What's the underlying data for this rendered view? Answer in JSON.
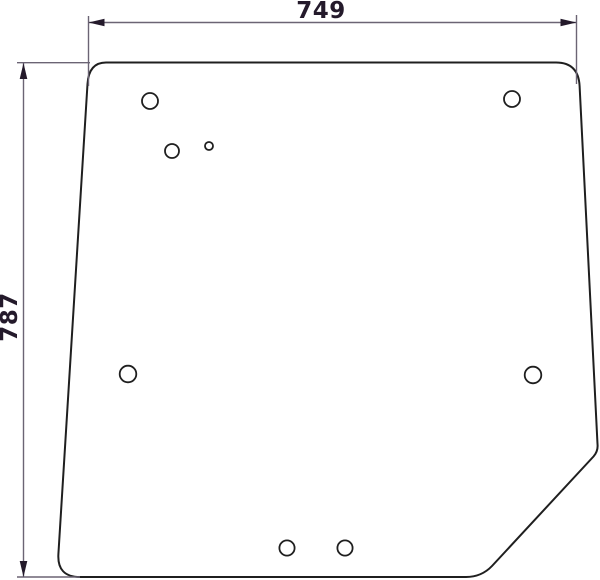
{
  "drawing": {
    "type": "technical-dimension-drawing",
    "subject": "glass-panel-with-mounting-holes",
    "dimensions": {
      "width_label": "749",
      "height_label": "787"
    },
    "panel": {
      "outline_path": "M 106 62.5 L 556 62.5 Q 578.4 62.5 579.6 86 L 597.5 444 Q 598.3 451 593.5 456.5 L 492 566 Q 481.5 577 466 577 L 80 577 Q 57 577 58.4 554 L 87.5 84 Q 88.8 62.5 106 62.5 Z",
      "holes": [
        {
          "name": "hole-top-left",
          "cx": 150,
          "cy": 101,
          "r": 8
        },
        {
          "name": "hole-upper-left-mid",
          "cx": 172,
          "cy": 151,
          "r": 7
        },
        {
          "name": "hole-upper-left-small",
          "cx": 209,
          "cy": 146,
          "r": 4
        },
        {
          "name": "hole-top-right",
          "cx": 512,
          "cy": 99,
          "r": 8
        },
        {
          "name": "hole-mid-left",
          "cx": 128,
          "cy": 374,
          "r": 8.3
        },
        {
          "name": "hole-mid-right",
          "cx": 533,
          "cy": 375,
          "r": 8.3
        },
        {
          "name": "hole-bottom-left",
          "cx": 287,
          "cy": 548,
          "r": 7.6
        },
        {
          "name": "hole-bottom-right",
          "cx": 345,
          "cy": 548,
          "r": 7.6
        }
      ]
    },
    "colors": {
      "bg": "#ffffff",
      "outline": "#1f1f1f",
      "dimline": "#6b6474",
      "dimdark": "#241a2b"
    }
  }
}
